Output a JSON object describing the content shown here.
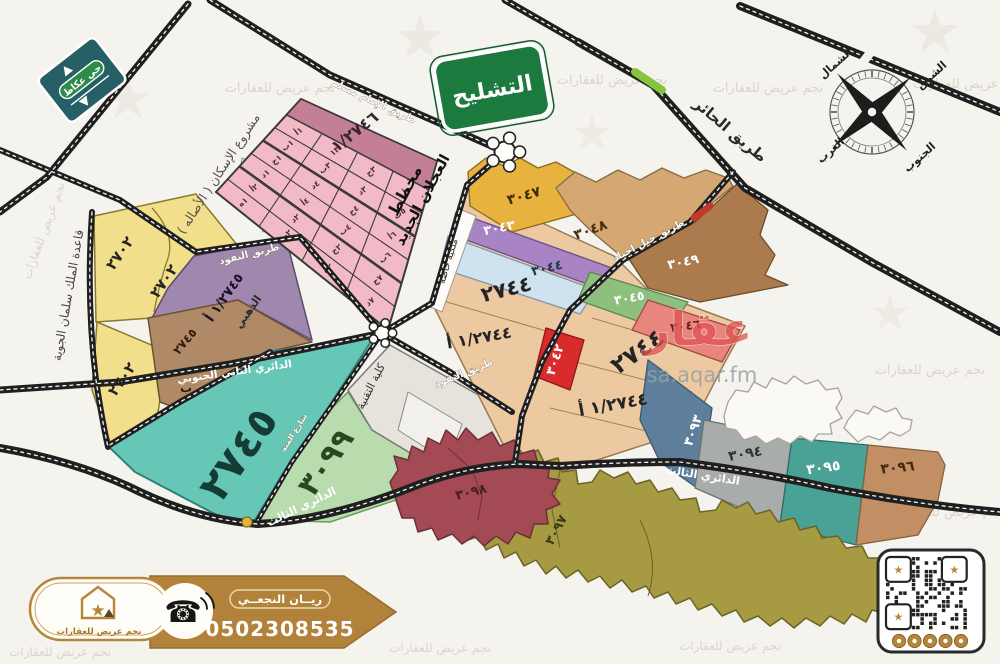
{
  "signs": {
    "okaz_district": "حي عكاظ",
    "tashleeh": "التشليح"
  },
  "plan": {
    "line1": "مخطط",
    "line2": "العجلان الجديد"
  },
  "roads": {
    "imam_muslim": "طريق الإمام مسلم",
    "al_hair": "طريق الحائر",
    "jabal_ajyad": "طريق جبل اجياد",
    "al_nafud": "طريق النفود",
    "ring2_south": "الدائري الثاني الجنوبي",
    "ring3": "الدائري الثالث",
    "street_100": "شارع المئة"
  },
  "areas": {
    "housing_project": "مشروع الإسكان ( الأصاله )",
    "airbase": "قاعدة الملك سلمان الجوية",
    "tech_college": "كلية التقنية",
    "private_property": "ملكية خاصة",
    "dhahabi": "الذهبي"
  },
  "parcels": {
    "n2746": "١/٢٧٤٦",
    "n2702": "٢٧٠٢",
    "n2745a": "١/٢٧٤٥ أ",
    "n2745": "٢٧٤٥",
    "letter_b": "ب",
    "n2744": "٢٧٤٤",
    "n2744a": "١/٢٧٤٤ أ",
    "n3042": "٣٠٤٢",
    "n3043": "٣٠٤٣",
    "n3044": "٣٠٤٤",
    "n3045": "٣٠٤٥",
    "n3046": "٣٠٤٦",
    "n3047": "٣٠٤٧",
    "n3048": "٣٠٤٨",
    "n3049": "٣٠٤٩",
    "n3093": "٣٠٩٣",
    "n3094": "٣٠٩٤",
    "n3095": "٣٠٩٥",
    "n3096": "٣٠٩٦",
    "n3097": "٣٠٩٧",
    "n3098": "٣٠٩٨",
    "n3099": "٣٠٩٩"
  },
  "grid": {
    "cells": [
      [
        "٥أ",
        "٣ج",
        "١٣",
        "١أ"
      ],
      [
        "٥ب",
        "٣د",
        "٣ب",
        "١ب"
      ],
      [
        "٦أ",
        "٤ج",
        "٤د",
        "١ج"
      ],
      [
        "٦ب",
        "٤ب",
        "٤أ",
        "١د"
      ],
      [
        "٧ج",
        "٢ج",
        "٢د",
        "٢أ"
      ],
      [
        "٧د",
        "٢ه",
        "٢ب",
        "١ه"
      ]
    ]
  },
  "compass": {
    "north": "الشمال",
    "east": "الشرق",
    "west": "الغرب",
    "south": "الجنوب"
  },
  "watermark": {
    "aqar": "عقار",
    "aqar_url": "sa.aqar.fm",
    "agency": "نجم عريض للعقارات"
  },
  "contact": {
    "agent_name": "ريــان النجعــي",
    "phone": "0502308535",
    "agency": "نجم عريض للعقارات"
  },
  "colors": {
    "accent_gold": "#b5853c",
    "sign_green": "#1d7a3f",
    "road_black": "#1f1f1f"
  }
}
